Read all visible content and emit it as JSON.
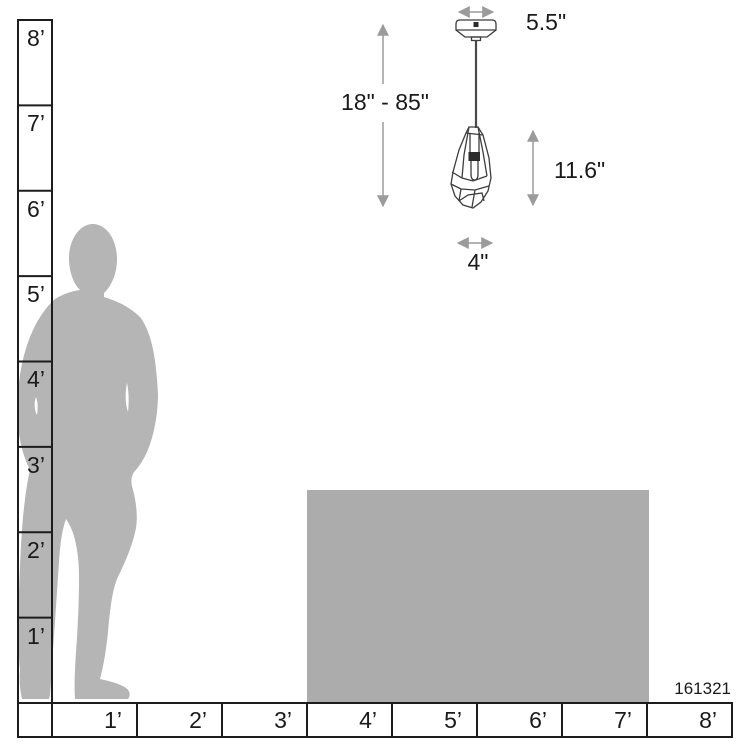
{
  "diagram": {
    "product_code": "161321",
    "fixture_dimensions": {
      "canopy_width": "5.5\"",
      "suspension_height_range": "18\" - 85\"",
      "shade_height": "11.6\"",
      "shade_width": "4\""
    },
    "vertical_scale": {
      "unit": "feet",
      "labels": [
        "8’",
        "7’",
        "6’",
        "5’",
        "4’",
        "3’",
        "2’",
        "1’"
      ]
    },
    "horizontal_scale": {
      "unit": "feet",
      "labels": [
        "1’",
        "2’",
        "3’",
        "4’",
        "5’",
        "6’",
        "7’",
        "8’"
      ]
    },
    "colors": {
      "background": "#ffffff",
      "ruler_line": "#1d1d1d",
      "text": "#1a1a1a",
      "silhouette_gray": "#b5b5b5",
      "furniture_gray": "#acacac",
      "dimension_gray": "#9b9b9b",
      "fixture_line": "#3d3d3d",
      "socket_dark": "#2b2b2b"
    }
  }
}
